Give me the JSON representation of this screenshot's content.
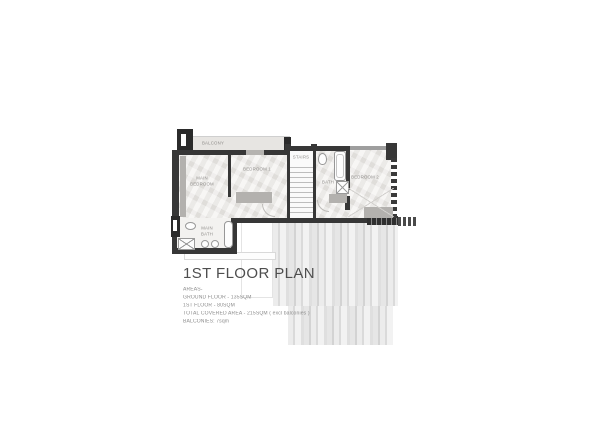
{
  "plan": {
    "title": "1ST FLOOR PLAN",
    "rooms": {
      "balcony": "BALCONY",
      "main_bedroom": "MAIN BEDROOM",
      "bedroom1": "BEDROOM 1",
      "stairs": "STAIRS",
      "bath": "BATH",
      "bedroom2": "BEDROOM 2",
      "main_bath": "MAIN BATH"
    },
    "colors": {
      "wall": "#373737",
      "floor": "#ebe9e6",
      "furniture": "#b3b1ae",
      "deck_light": "#f2f2f2",
      "deck_dark": "#d3d3d3",
      "title_text": "#4e4e4e",
      "note_text": "#8c8c8c"
    }
  },
  "notes": {
    "heading": "AREAS-",
    "lines": [
      "GROUND FLOOR - 135SQM",
      "1ST FLOOR - 80SQM",
      "TOTAL COVERED AREA - 215SQM ( excl balconies )",
      "BALCONIES: 7sqm"
    ]
  }
}
